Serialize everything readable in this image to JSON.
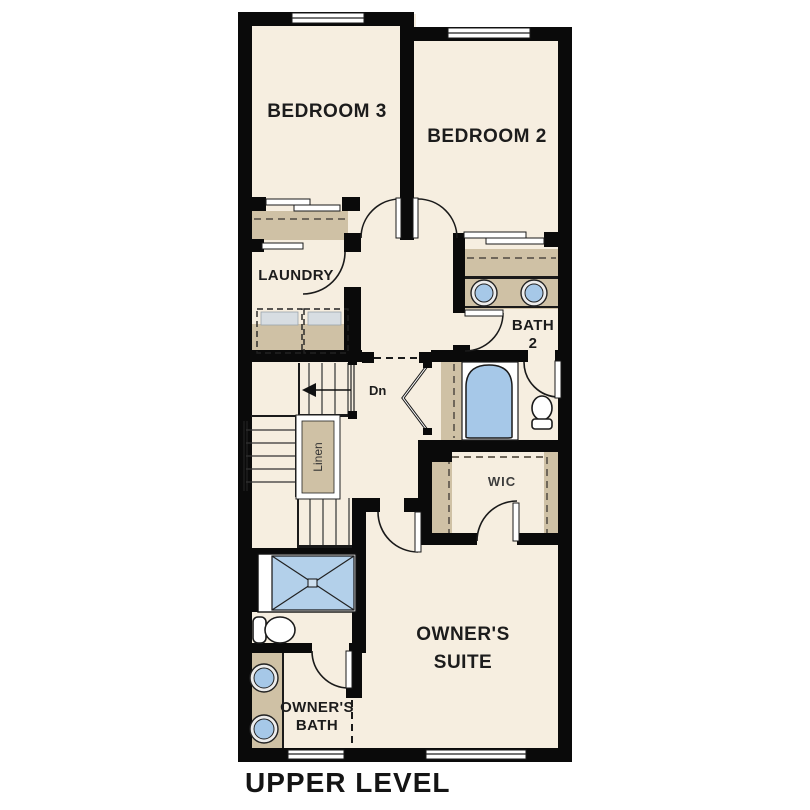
{
  "title": "UPPER LEVEL",
  "rooms": {
    "bedroom3": "BEDROOM 3",
    "bedroom2": "BEDROOM 2",
    "laundry": "LAUNDRY",
    "bath2_line1": "BATH",
    "bath2_line2": "2",
    "wic": "WIC",
    "owners_suite_line1": "OWNER'S",
    "owners_suite_line2": "SUITE",
    "owners_bath_line1": "OWNER'S",
    "owners_bath_line2": "BATH",
    "linen": "Linen",
    "stairs_down": "Dn"
  },
  "colors": {
    "wall": "#0a0a0a",
    "floor": "#f6eee0",
    "cabinetry_tan": "#cfc1a5",
    "fixture_blue": "#a6c8e8",
    "appliance_gray": "#d7dde2",
    "background": "#ffffff",
    "text": "#1c1c1c"
  }
}
